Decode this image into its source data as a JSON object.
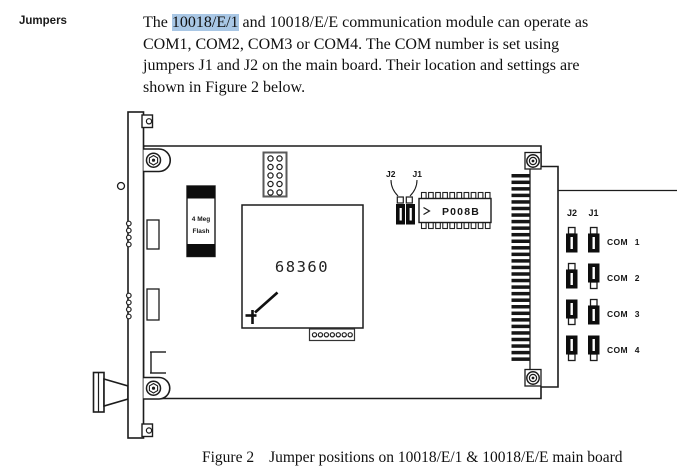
{
  "page": {
    "heading": "Jumpers",
    "paragraph": {
      "highlight_color": "#a9c7e5",
      "lines": [
        {
          "segments": [
            {
              "text": "The "
            },
            {
              "text": "10018/E/1",
              "highlight": true
            },
            {
              "text": " and 10018/E/E communication module can operate as"
            }
          ]
        },
        {
          "segments": [
            {
              "text": "COM1, COM2, COM3 or COM4. The COM number is set using"
            }
          ]
        },
        {
          "segments": [
            {
              "text": "jumpers J1 and J2 on the main board. Their location and settings are"
            }
          ]
        },
        {
          "segments": [
            {
              "text": "shown in Figure 2 below."
            }
          ]
        }
      ]
    },
    "caption": {
      "label": "Figure 2",
      "text": "Jumper positions on 10018/E/1 & 10018/E/E main board"
    }
  },
  "figure": {
    "board_labels": {
      "flash_line1": "4 Meg",
      "flash_line2": "Flash",
      "cpu": "68360",
      "eprom": "P008B",
      "jumper_j2": "J2",
      "jumper_j1": "J1"
    },
    "legend": {
      "j2_header": "J2",
      "j1_header": "J1",
      "rows": [
        {
          "label": "COM 1",
          "j2": "down",
          "j1": "down"
        },
        {
          "label": "COM 2",
          "j2": "down",
          "j1": "up"
        },
        {
          "label": "COM 3",
          "j2": "up",
          "j1": "down"
        },
        {
          "label": "COM 4",
          "j2": "up",
          "j1": "up"
        }
      ]
    }
  },
  "colors": {
    "line": "#1c1c1c",
    "jumper_block": "#0d0d0d",
    "highlight": "#a9c7e5"
  }
}
